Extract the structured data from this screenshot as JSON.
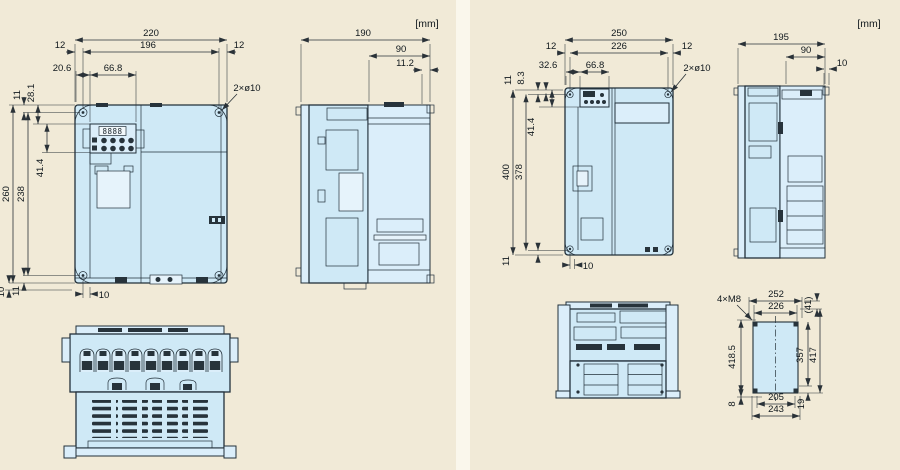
{
  "left_panel": {
    "unit": "[mm]",
    "front": {
      "overall_width": "220",
      "hole_span": "196",
      "margin_left": "12",
      "margin_right": "12",
      "keypad_offset": "20.6",
      "keypad_width": "66.8",
      "top_margin": "11",
      "keypad_top": "28.1",
      "keypad_height": "41.4",
      "overall_height": "260",
      "hole_span_v": "238",
      "bottom_a": "10",
      "bottom_b": "11",
      "foot_offset": "10",
      "hole_note": "2×ø10",
      "display": "8888"
    },
    "side": {
      "depth": "190",
      "cover_depth": "90",
      "protrusion": "11.2"
    }
  },
  "right_panel": {
    "unit": "[mm]",
    "front": {
      "overall_width": "250",
      "hole_span": "226",
      "margin_left": "12",
      "margin_right": "12",
      "keypad_offset": "32.6",
      "keypad_width": "66.8",
      "top_margin": "11",
      "top_offset": "8.3",
      "keypad_height": "41.4",
      "overall_height": "400",
      "hole_span_v": "378",
      "bottom_margin": "11",
      "foot_offset": "10",
      "hole_note": "2×ø10"
    },
    "side": {
      "depth": "195",
      "cover_depth": "90",
      "protrusion": "10"
    },
    "footprint": {
      "screw_note": "4×M8",
      "outer_width": "252",
      "hole_span": "226",
      "offset_41": "(41)",
      "height_a": "418.5",
      "height_b": "357",
      "height_c": "417",
      "bottom_margin": "8",
      "span_205": "205",
      "offset_19": "19",
      "outer_width_b": "243"
    }
  }
}
